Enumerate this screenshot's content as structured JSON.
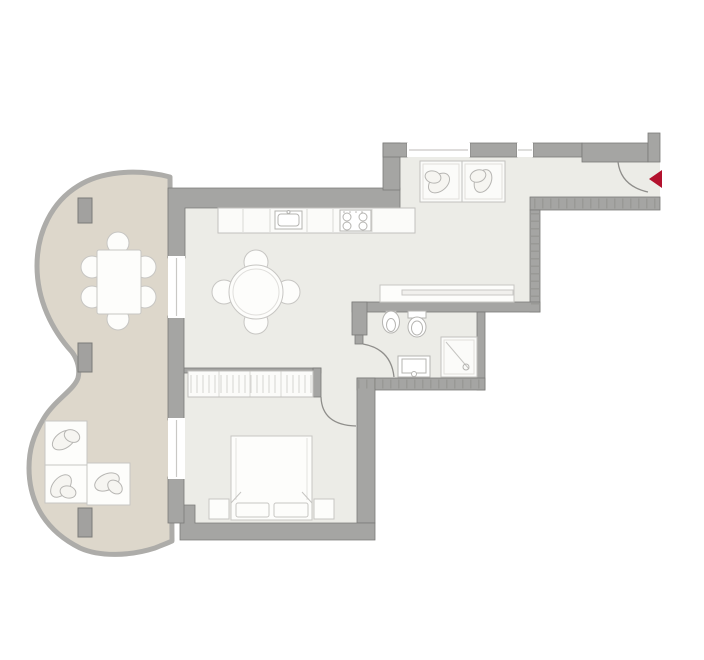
{
  "figure": {
    "kind": "apartment-floor-plan",
    "view": "top-down",
    "text_labels": "none"
  },
  "colors": {
    "background": "#ffffff",
    "floor": "#ecece7",
    "balcony_floor": "#ddd7cb",
    "wall": "#a5a5a3",
    "wall_outline": "#7b7b79",
    "balcony_border": "#adaca9",
    "furniture_fill": "#fdfdfb",
    "furniture_stroke": "#c7c6c3",
    "fixture_stroke": "#b5b4b1",
    "window_glazing": "#c9c8c5",
    "entrance_arrow": "#b3122e"
  },
  "rooms": {
    "balcony": {
      "shape": "double-lobe curved terrace",
      "pillar_count": 3,
      "furniture": [
        "rectangular-dining-table",
        "dining-chair x6",
        "armchair x2",
        "sofa"
      ]
    },
    "kitchen": {
      "fixtures": [
        "cabinet-counter-run",
        "kitchen-sink",
        "cooktop-4-burner"
      ]
    },
    "living_dining": {
      "furniture": [
        "round-table",
        "chair x4"
      ]
    },
    "hallway": {
      "furniture": [
        "console-table",
        "laundry-appliance x2"
      ]
    },
    "bathroom": {
      "fixtures": [
        "bidet",
        "toilet",
        "vanity-washbasin",
        "shower"
      ]
    },
    "bedroom": {
      "furniture": [
        "wardrobe-with-hangers",
        "double-bed",
        "pillow x2",
        "nightstand x2"
      ]
    },
    "entrance": {
      "marker": "red-entry-arrow",
      "door_swing": "quarter-arc"
    }
  },
  "openings": {
    "balcony_windows": 2,
    "corridor_windows": 2,
    "interior_doors": 2,
    "entry_door": 1
  }
}
